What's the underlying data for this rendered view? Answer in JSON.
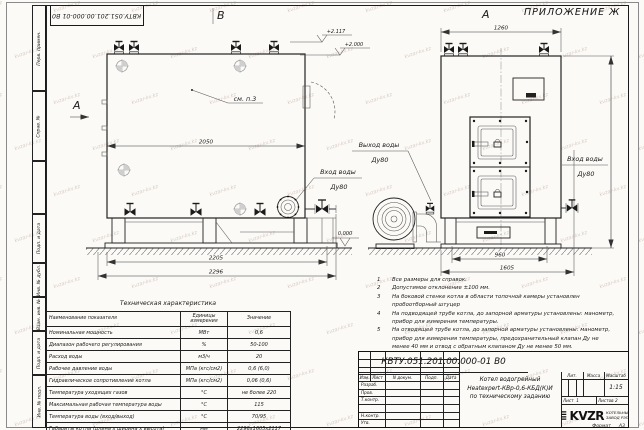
{
  "sheet": {
    "appendix": "ПРИЛОЖЕНИЕ Ж",
    "stamp_number": "КВТУ.051.201.00.000-01 В0",
    "watermark": "kvzar-kv.kz",
    "side_labels": [
      "Перв. примен.",
      "Справ. №",
      "",
      "Подп. и дата",
      "Инв. № дубл.",
      "Взам. инв. №",
      "Подп. и дата",
      "Инв. № подл."
    ]
  },
  "drawing": {
    "view_b": "В",
    "view_a_side": "А",
    "view_a_front": "А",
    "see_note": "см. п.3",
    "dims": {
      "side_width": "2050",
      "side_base": "2205",
      "side_total": "2296",
      "front_width": "1260",
      "front_base": "960",
      "front_total": "1605"
    },
    "elevations": {
      "top": "+2.117",
      "mid": "+2.000",
      "zero": "0.000"
    },
    "labels": {
      "inlet_side": {
        "line1": "Вход воды",
        "line2": "Ду80"
      },
      "outlet": {
        "line1": "Выход воды",
        "line2": "Ду80"
      },
      "inlet_front": {
        "line1": "Вход воды",
        "line2": "Ду80"
      }
    }
  },
  "notes": {
    "items": [
      {
        "num": "1",
        "text": "Все размеры для справок."
      },
      {
        "num": "2",
        "text": "Допустимое отклонение ±100 мм."
      },
      {
        "num": "3",
        "text": "На боковой стенке котла в области топочной камеры установлен пробоотборный штуцер"
      },
      {
        "num": "4",
        "text": "На подводящей трубе котла, до запорной арматуры установлены: манометр, прибор для измерения температуры."
      },
      {
        "num": "5",
        "text": "На отводящей трубе котла, до запорной арматуры установлены: манометр, прибор для измерения температуры, предохранительный клапан Ду не менее 40 мм и отвод с обратным клапаном Ду не менее 50 мм."
      }
    ]
  },
  "tech_table": {
    "title": "Техническая характеристика",
    "headers": [
      "Наименование показателя",
      "Единицы измерения",
      "Значение"
    ],
    "rows": [
      [
        "Номинальная мощность",
        "МВт",
        "0,6"
      ],
      [
        "Диапазон рабочего регулирования",
        "%",
        "50-100"
      ],
      [
        "Расход воды",
        "м3/ч",
        "20"
      ],
      [
        "Рабочее давление воды",
        "МПа (кгс/см2)",
        "0,6 (6,0)"
      ],
      [
        "Гидравлическое сопротивление котла",
        "МПа (кгс/см2)",
        "0,06 (0,6)"
      ],
      [
        "Температура уходящих газов",
        "°С",
        "не более 220"
      ],
      [
        "Максимальная рабочая температура воды",
        "°С",
        "115"
      ],
      [
        "Температура воды (вход/выход)",
        "°С",
        "70/95"
      ],
      [
        "Габариты котла (длина х ширина х высота)",
        "мм",
        "2296х1605х2117"
      ]
    ]
  },
  "title_block": {
    "number": "КВТУ.051.201.00.000-01 В0",
    "product_line1": "Котел водогрейный",
    "product_line2": "Heatexpert-КВр-0,6-КБД(К)И",
    "product_line3": "по техническому заданию",
    "col_headers": [
      "Изм.",
      "Лист",
      "N докум.",
      "Подп.",
      "Дата"
    ],
    "row_labels": [
      "Разраб.",
      "Пров.",
      "Т.контр.",
      "",
      "Н.контр.",
      "Утв."
    ],
    "lit_label": "Лит.",
    "mass_label": "Масса",
    "scale_label": "Масштаб",
    "scale_value": "1:15",
    "sheet_label": "Лист",
    "sheet_value": "1",
    "sheets_label": "Листов",
    "sheets_value": "2",
    "logo": "KVZR",
    "company_line1": "КОТЕЛЬНЫЙ",
    "company_line2": "ЗАВОД РЭП",
    "format_label": "Формат",
    "format_value": "А3"
  }
}
